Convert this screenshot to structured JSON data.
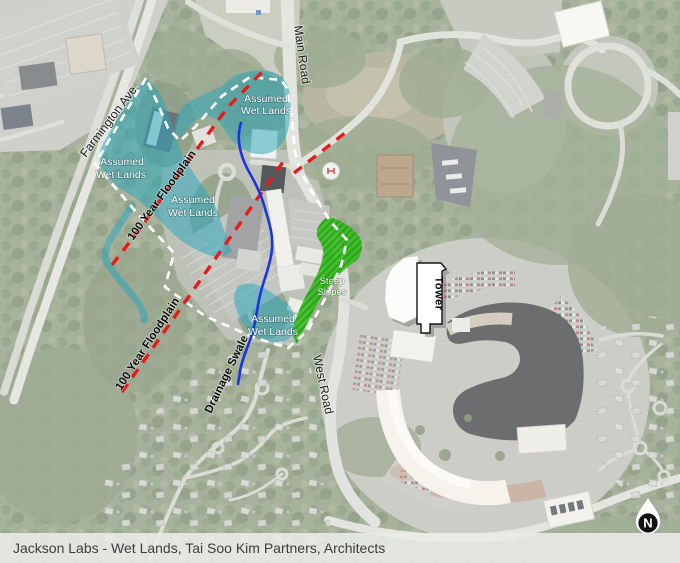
{
  "caption": {
    "text": "Jackson Labs - Wet Lands, Tai Soo Kim Partners, Architects"
  },
  "map": {
    "road_labels": {
      "farmington": "Farmington Ave.",
      "main": "Main Road",
      "west": "West Road"
    },
    "annotations": {
      "floodplain_upper": "100 Year Floodplain",
      "floodplain_lower": "100 Year Floodplain",
      "drainage": "Drainage Swale",
      "wetland_line1": "Assumed",
      "wetland_line2": "Wet Lands",
      "steep_line1": "Steep",
      "steep_line2": "Slopes",
      "tower": "Tower"
    },
    "compass": {
      "label": "N"
    },
    "colors": {
      "wetland_fill": "#2aa7bd",
      "steep_slope_fill": "#35bd1e",
      "floodplain_line": "#e81b1b",
      "drainage_line": "#1a35e0",
      "boundary_line": "#ffffff"
    }
  }
}
